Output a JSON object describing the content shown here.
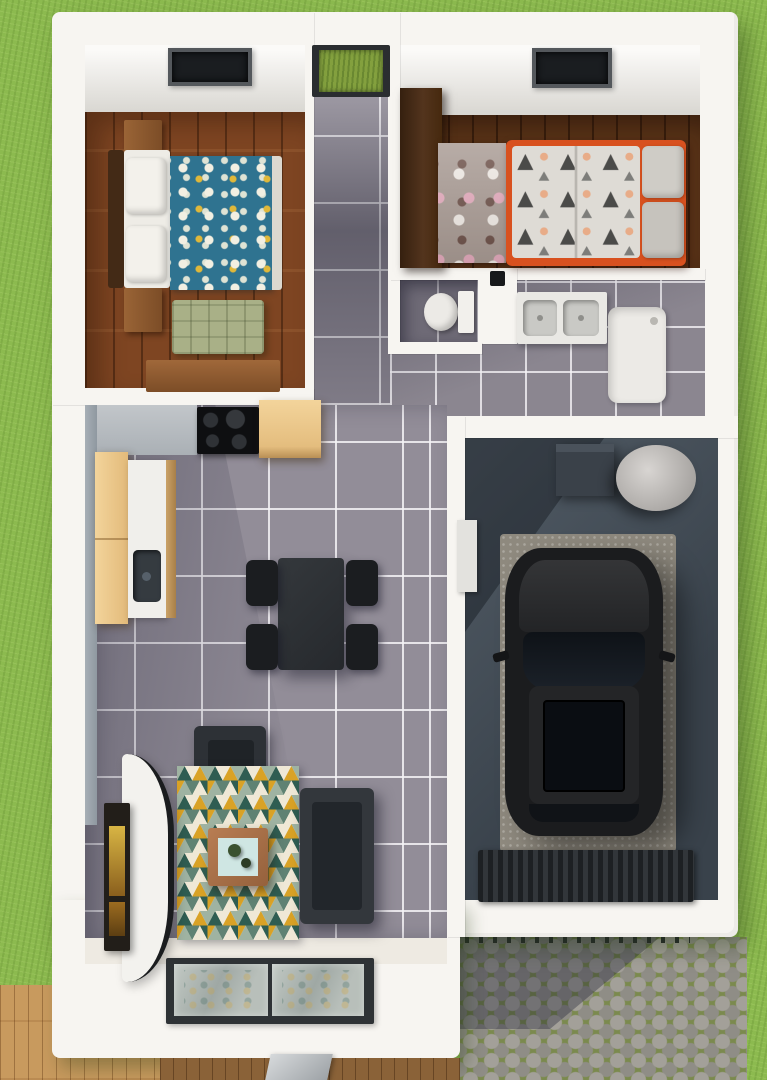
{
  "scene": {
    "description": "Top-down 3D architectural rendering of a small single-storey house: two bedrooms, bathroom and WC, open kitchen-dining-living area, attached garage with parked black SUV, surrounded by lawn, a wooden deck and a cobblestone driveway",
    "view": "top-down 3D render",
    "canvas": {
      "width_px": 767,
      "height_px": 1080
    }
  },
  "palette": {
    "grass": "#8cba4f",
    "wall_white": "#f7f5f1",
    "tile": "#928d98",
    "tile_dark": "#6e6a76",
    "wood_master": "#7e4522",
    "wood_kids": "#5a3418",
    "duvet_teal": "#2f7390",
    "bed_orange": "#d8511f",
    "kids_rug": "#a89a93",
    "duvet_kids": "#dedbd5",
    "tri_dark": "#4b4b49",
    "dot_peach": "#e8ac88",
    "bench_green": "#a9b087",
    "cabinet_beige": "#eec98f",
    "counter_light": "#b7bbc0",
    "counter_white": "#f0efeb",
    "appliance_black": "#0e0f11",
    "furniture_dark": "#2c3034",
    "chair_black": "#1b1d20",
    "garage_floor_a": "#525c66",
    "garage_floor_b": "#39424b",
    "garage_pad": "#8e897e",
    "car_black": "#1b1c1e",
    "fixture_white": "#eceae6",
    "cobble_stone": "#a3a099",
    "cobble_moss": "#7b8a4e",
    "deck_wood": "#c89a5e",
    "deck_wood_dark": "#8a6238",
    "glass_green": "#83a03e",
    "glass_window": "#b3bab7",
    "rug_teal": "#2f5d52",
    "rug_green": "#5f8273",
    "rug_sage": "#9fb3a2",
    "rug_cream": "#efe8d6",
    "rug_yellow": "#d9a226",
    "table_wood": "#a9714a",
    "table_top": "#cfe6e3",
    "mattress_white": "#eeece6"
  },
  "rooms": {
    "master_bedroom": {
      "name": "master bedroom",
      "furniture": [
        "double bed with teal floral duvet",
        "dark headboard",
        "two wooden nightstands",
        "green quilted bench",
        "wooden desk",
        "ceiling skylight"
      ]
    },
    "hallway": {
      "name": "entry hallway",
      "furniture": [
        "glazed entry door showing lawn"
      ]
    },
    "kids_bedroom": {
      "name": "kids bedroom",
      "furniture": [
        "orange bed with triangle-pattern duvet and two grey pillows",
        "dark wood wardrobe",
        "taupe rug with pink and crown motifs",
        "ceiling skylight"
      ]
    },
    "wc": {
      "name": "toilet room",
      "furniture": [
        "toilet"
      ]
    },
    "bathroom": {
      "name": "bathroom",
      "furniture": [
        "double-basin sink counter",
        "shower tray"
      ]
    },
    "garage": {
      "name": "garage",
      "furniture": [
        "black SUV on concrete pad",
        "storage box",
        "water tank cylinder",
        "ribbed entry mat",
        "side door panel"
      ]
    },
    "kitchen": {
      "name": "kitchen",
      "furniture": [
        "four-burner cooktop",
        "beige corner cabinet",
        "tall beige cabinet",
        "white counter with dark sink"
      ]
    },
    "dining": {
      "name": "dining area",
      "furniture": [
        "dark dining table",
        "four black chairs"
      ]
    },
    "living_room": {
      "name": "living room",
      "furniture": [
        "dark sofa",
        "dark armchair",
        "triangle-pattern rug",
        "wooden coffee table with plants",
        "curved white tv stand",
        "wall-mounted tv art",
        "south-facing window wall"
      ]
    }
  },
  "exterior": {
    "features": [
      "lawn",
      "light wooden deck",
      "shaded deck strip",
      "cobblestone driveway with moss joints",
      "garage door track"
    ]
  }
}
